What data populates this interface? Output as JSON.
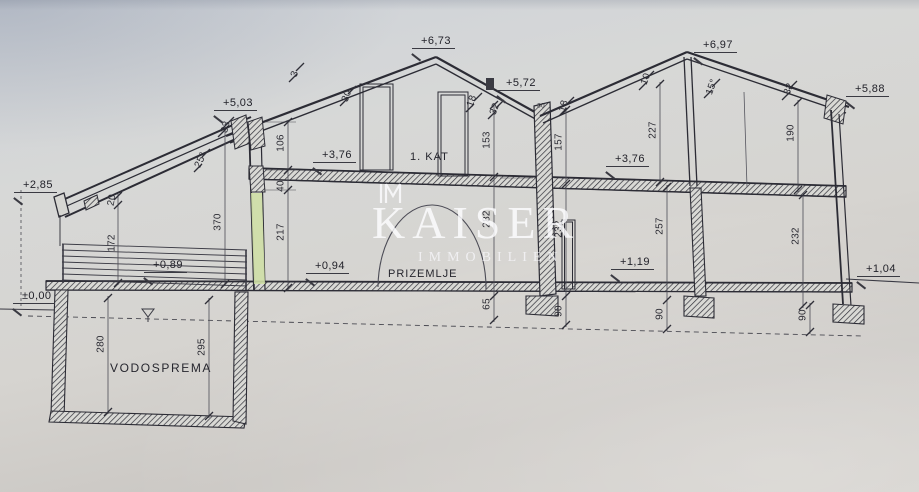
{
  "drawing": {
    "kind": "building cross-section",
    "paper_color": "#d2d2cf",
    "line_color": "#2c2c35",
    "highlight_wall_color": "#cfdfa6"
  },
  "watermark": {
    "brand": "KAISER",
    "subtitle": "IMMOBILIEN"
  },
  "rooms": [
    {
      "name": "room-label-1kat",
      "text": "1. KAT",
      "x": 410,
      "y": 151,
      "fs": 11
    },
    {
      "name": "room-label-prizemlje",
      "text": "PRIZEMLJE",
      "x": 388,
      "y": 268,
      "fs": 11
    },
    {
      "name": "room-label-vodosprema",
      "text": "VODOSPREMA",
      "x": 110,
      "y": 361,
      "fs": 12,
      "ls": 1.6
    }
  ],
  "levels": [
    {
      "text": "+6,73",
      "x": 412,
      "y": 35
    },
    {
      "text": "+6,97",
      "x": 694,
      "y": 39
    },
    {
      "text": "+5,72",
      "x": 497,
      "y": 77
    },
    {
      "text": "+5,88",
      "x": 846,
      "y": 83
    },
    {
      "text": "+5,03",
      "x": 214,
      "y": 97
    },
    {
      "text": "+3,76",
      "x": 313,
      "y": 149
    },
    {
      "text": "+3,76",
      "x": 606,
      "y": 153
    },
    {
      "text": "+2,85",
      "x": 14,
      "y": 179
    },
    {
      "text": "+0,94",
      "x": 306,
      "y": 260
    },
    {
      "text": "+0,89",
      "x": 144,
      "y": 259
    },
    {
      "text": "±0,00",
      "x": 13,
      "y": 290
    },
    {
      "text": "+1,19",
      "x": 611,
      "y": 256
    },
    {
      "text": "+1,04",
      "x": 857,
      "y": 263
    }
  ],
  "dimensions": [
    {
      "text": "370",
      "x": 218,
      "y": 222
    },
    {
      "text": "217",
      "x": 281,
      "y": 232
    },
    {
      "text": "40",
      "x": 281,
      "y": 186
    },
    {
      "text": "106",
      "x": 281,
      "y": 143
    },
    {
      "text": "172",
      "x": 112,
      "y": 243
    },
    {
      "text": "20",
      "x": 112,
      "y": 200,
      "rot": -80
    },
    {
      "text": "33",
      "x": 226,
      "y": 127,
      "rot": -75
    },
    {
      "text": "25°",
      "x": 201,
      "y": 160,
      "rot": -65
    },
    {
      "text": "3",
      "x": 295,
      "y": 74,
      "rot": -70
    },
    {
      "text": "30",
      "x": 347,
      "y": 96,
      "rot": -70
    },
    {
      "text": "18",
      "x": 472,
      "y": 101,
      "rot": -70
    },
    {
      "text": "32",
      "x": 495,
      "y": 109,
      "rot": -70
    },
    {
      "text": "153",
      "x": 487,
      "y": 140
    },
    {
      "text": "282",
      "x": 487,
      "y": 219
    },
    {
      "text": "65",
      "x": 487,
      "y": 304
    },
    {
      "text": "30",
      "x": 541,
      "y": 106,
      "rot": 0,
      "fs": 6.5
    },
    {
      "text": "18",
      "x": 564,
      "y": 106,
      "rot": -75
    },
    {
      "text": "157",
      "x": 559,
      "y": 142
    },
    {
      "text": "232",
      "x": 559,
      "y": 229
    },
    {
      "text": "90",
      "x": 559,
      "y": 311
    },
    {
      "text": "10",
      "x": 646,
      "y": 79,
      "rot": -70
    },
    {
      "text": "227",
      "x": 653,
      "y": 130
    },
    {
      "text": "257",
      "x": 660,
      "y": 226
    },
    {
      "text": "90",
      "x": 660,
      "y": 314
    },
    {
      "text": "15°",
      "x": 712,
      "y": 87,
      "rot": -70
    },
    {
      "text": "32",
      "x": 789,
      "y": 89,
      "rot": -70
    },
    {
      "text": "190",
      "x": 791,
      "y": 133
    },
    {
      "text": "232",
      "x": 796,
      "y": 236
    },
    {
      "text": "90",
      "x": 803,
      "y": 315
    },
    {
      "text": "280",
      "x": 101,
      "y": 344
    },
    {
      "text": "295",
      "x": 202,
      "y": 347
    }
  ]
}
